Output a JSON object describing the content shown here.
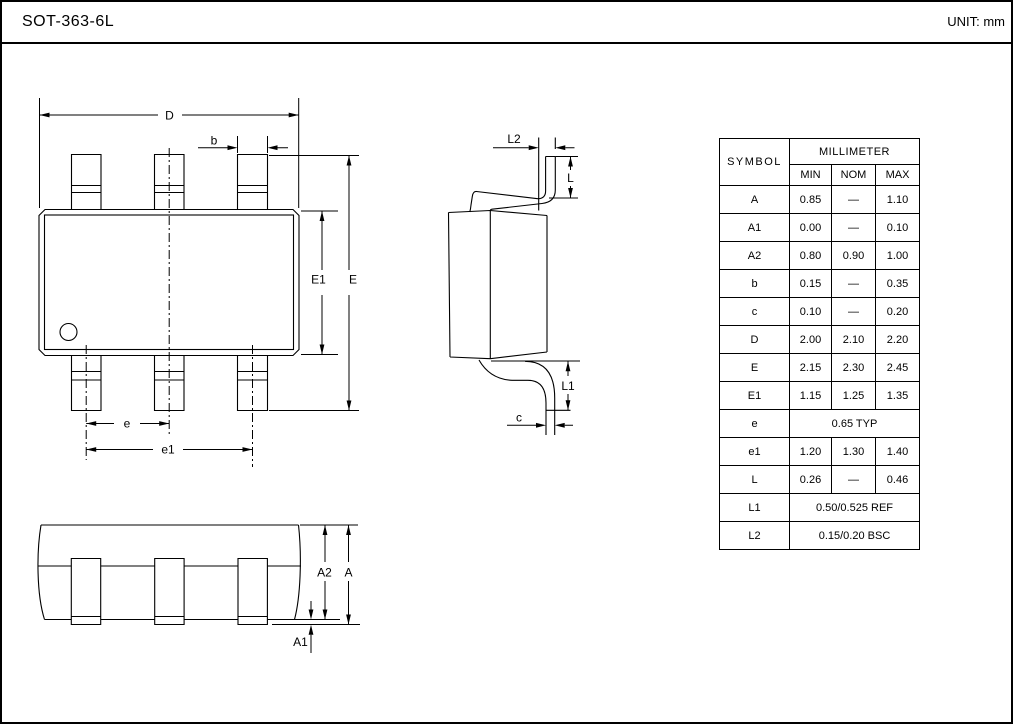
{
  "header": {
    "title": "SOT-363-6L",
    "unit": "UNIT: mm"
  },
  "drawing": {
    "labels": {
      "D": "D",
      "b": "b",
      "E": "E",
      "E1": "E1",
      "e": "e",
      "e1": "e1",
      "L2": "L2",
      "L": "L",
      "L1": "L1",
      "c": "c",
      "A2": "A2",
      "A": "A",
      "A1": "A1"
    }
  },
  "table": {
    "col_symbol": "SYMBOL",
    "col_unit": "MILLIMETER",
    "col_min": "MIN",
    "col_nom": "NOM",
    "col_max": "MAX",
    "rows": [
      {
        "symbol": "A",
        "min": "0.85",
        "nom": "—",
        "max": "1.10"
      },
      {
        "symbol": "A1",
        "min": "0.00",
        "nom": "—",
        "max": "0.10"
      },
      {
        "symbol": "A2",
        "min": "0.80",
        "nom": "0.90",
        "max": "1.00"
      },
      {
        "symbol": "b",
        "min": "0.15",
        "nom": "—",
        "max": "0.35"
      },
      {
        "symbol": "c",
        "min": "0.10",
        "nom": "—",
        "max": "0.20"
      },
      {
        "symbol": "D",
        "min": "2.00",
        "nom": "2.10",
        "max": "2.20"
      },
      {
        "symbol": "E",
        "min": "2.15",
        "nom": "2.30",
        "max": "2.45"
      },
      {
        "symbol": "E1",
        "min": "1.15",
        "nom": "1.25",
        "max": "1.35"
      },
      {
        "symbol": "e",
        "span": "0.65 TYP"
      },
      {
        "symbol": "e1",
        "min": "1.20",
        "nom": "1.30",
        "max": "1.40"
      },
      {
        "symbol": "L",
        "min": "0.26",
        "nom": "—",
        "max": "0.46"
      },
      {
        "symbol": "L1",
        "span": "0.50/0.525 REF"
      },
      {
        "symbol": "L2",
        "span": "0.15/0.20 BSC"
      }
    ]
  }
}
